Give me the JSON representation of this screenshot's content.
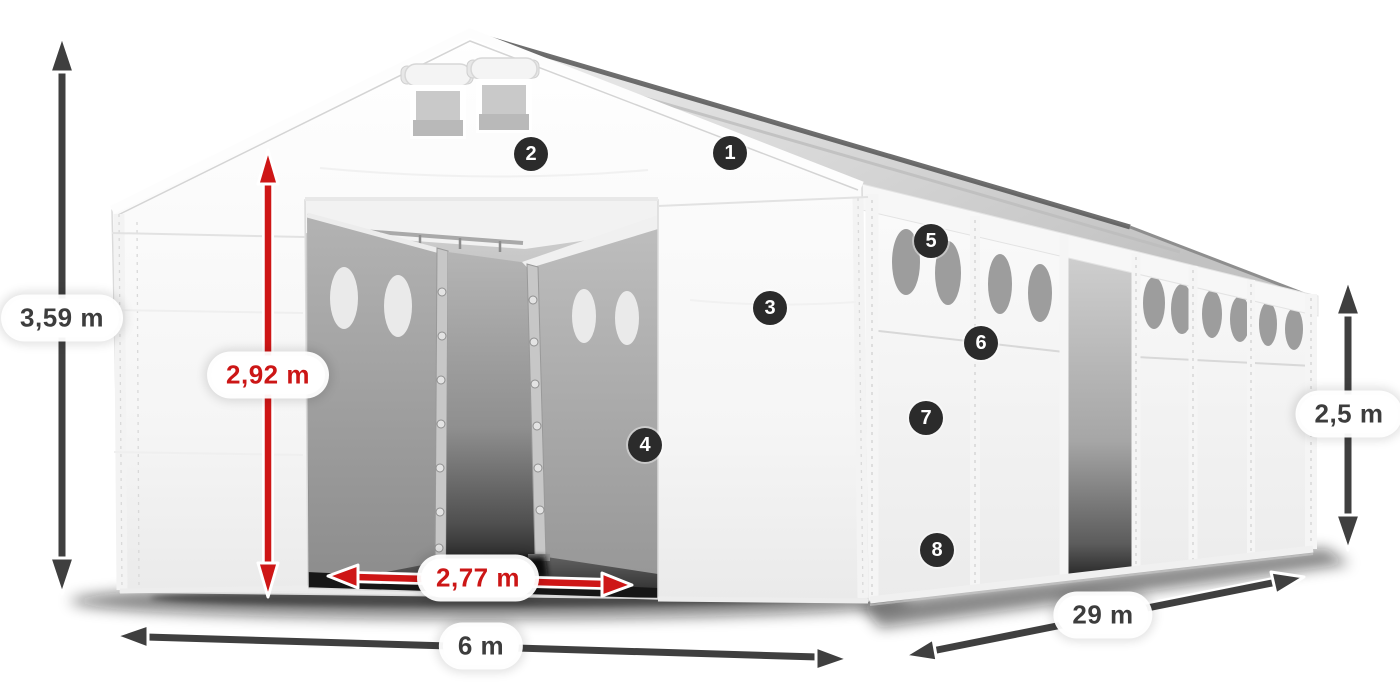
{
  "figure": {
    "subject": "White modular storage tent in three-quarter view with dimension arrows and numbered part callouts",
    "background_color": "#ffffff"
  },
  "dimension_labels": {
    "total_height": {
      "text": "3,59 m",
      "style": "dark"
    },
    "inner_height": {
      "text": "2,92 m",
      "style": "red"
    },
    "entrance_width": {
      "text": "2,77 m",
      "style": "red"
    },
    "width": {
      "text": "6 m",
      "style": "dark"
    },
    "length": {
      "text": "29 m",
      "style": "dark"
    },
    "side_height": {
      "text": "2,5 m",
      "style": "dark"
    }
  },
  "callouts": [
    {
      "number": "1"
    },
    {
      "number": "2"
    },
    {
      "number": "3"
    },
    {
      "number": "4"
    },
    {
      "number": "5"
    },
    {
      "number": "6"
    },
    {
      "number": "7"
    },
    {
      "number": "8"
    }
  ],
  "colors": {
    "dark_arrow": "#3f3f3f",
    "red_arrow": "#ce1616",
    "badge_background": "#2b2b2b",
    "badge_text": "#ffffff",
    "label_dark_text": "#3d3d3d",
    "label_red_text": "#cc1616",
    "tent_fabric": "#ffffff",
    "interior_panel_gray": "#a0a0a0",
    "window_gray": "#9d9d9d"
  }
}
